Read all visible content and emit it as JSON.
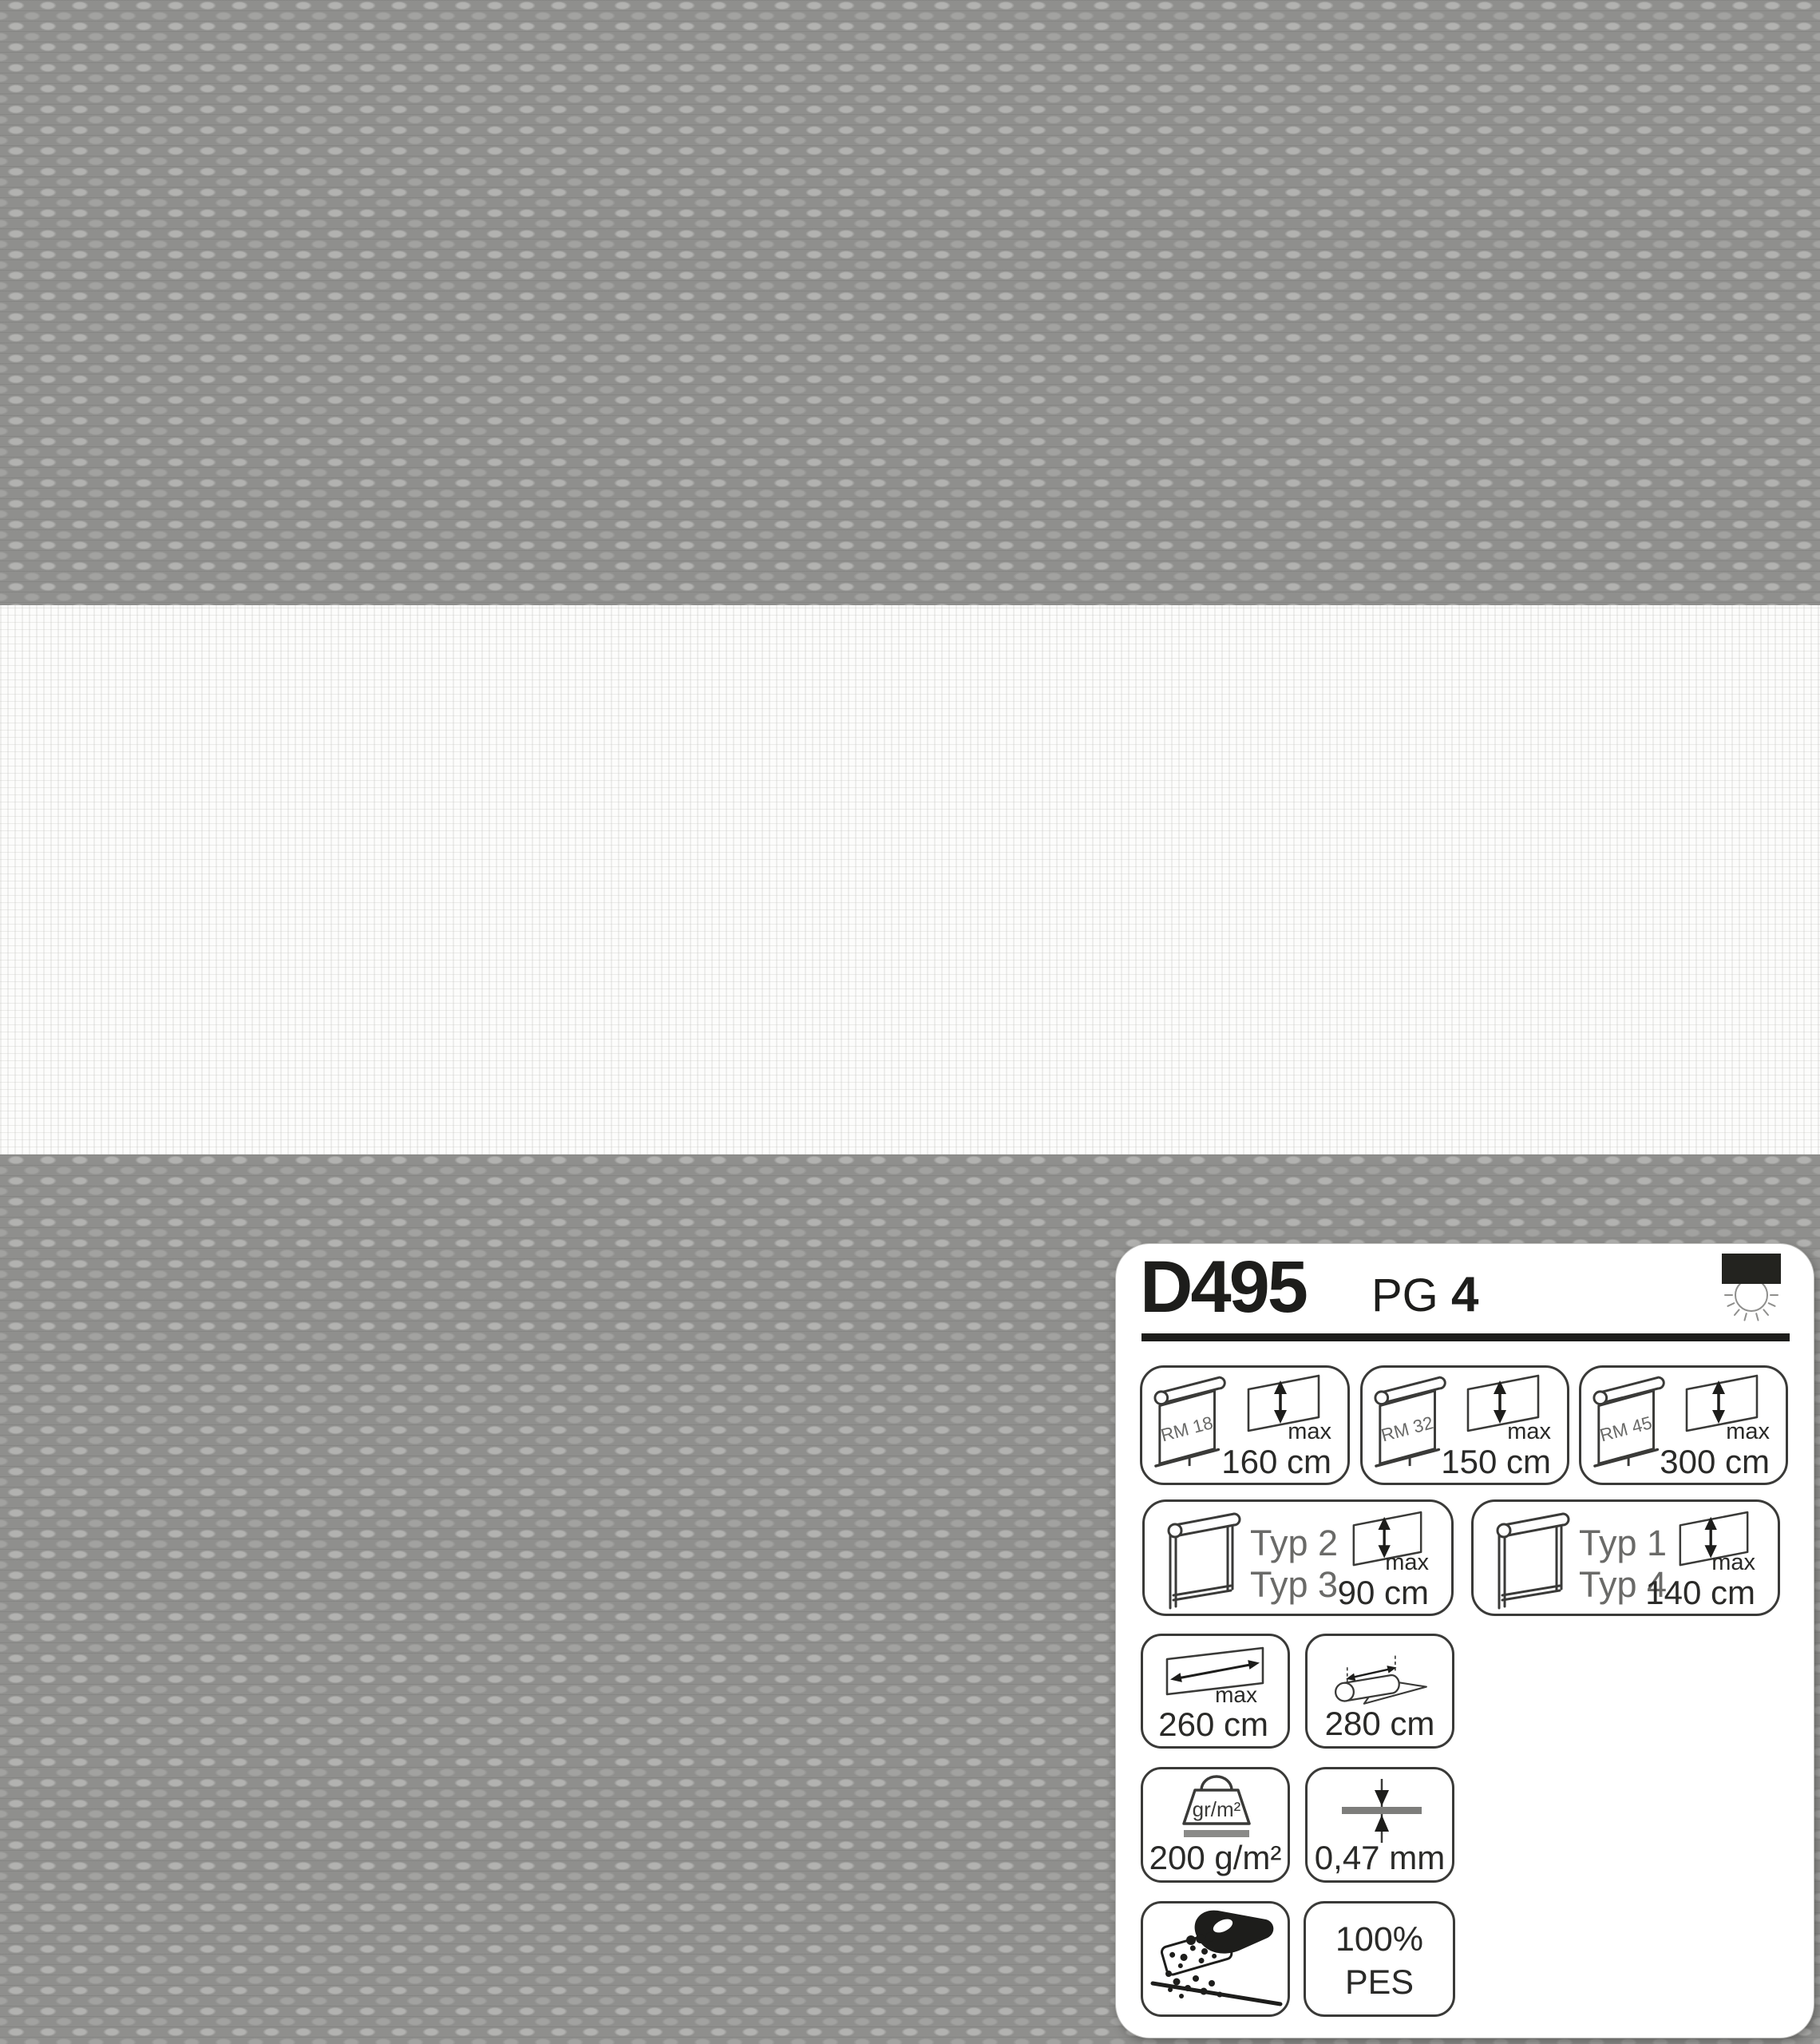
{
  "colors": {
    "fabric_gray": "#8f8f8d",
    "fabric_highlight": "#b2b2b0",
    "band_white": "#fcfcfb",
    "panel_bg": "#ffffff",
    "ink": "#1d1d1b",
    "label_gray": "#6a6a68",
    "bar_gray": "#8a8a88"
  },
  "panel": {
    "header": {
      "code": "D495",
      "pg_label": "PG",
      "pg_value": "4"
    },
    "rm_systems": [
      {
        "system": "RM 18",
        "max_label": "max",
        "max_value": "160 cm"
      },
      {
        "system": "RM 32",
        "max_label": "max",
        "max_value": "150 cm"
      },
      {
        "system": "RM 45",
        "max_label": "max",
        "max_value": "300 cm"
      }
    ],
    "typ_systems": [
      {
        "type_a": "Typ 2",
        "type_b": "Typ 3",
        "max_label": "max",
        "max_value": "90 cm"
      },
      {
        "type_a": "Typ 1",
        "type_b": "Typ 4",
        "max_label": "max",
        "max_value": "140 cm"
      }
    ],
    "max_width": {
      "max_label": "max",
      "value": "260 cm"
    },
    "roll_width": {
      "value": "280 cm"
    },
    "weight": {
      "unit_label": "gr/m²",
      "value": "200 g/m²"
    },
    "thickness": {
      "value": "0,47 mm"
    },
    "composition": {
      "line1": "100%",
      "line2": "PES"
    }
  }
}
